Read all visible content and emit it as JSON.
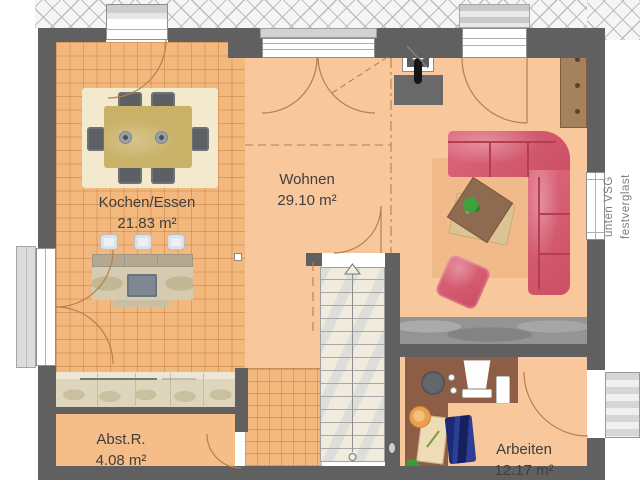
{
  "plan": {
    "rooms": [
      {
        "name": "Kochen/Essen",
        "area": "21.83 m²"
      },
      {
        "name": "Wohnen",
        "area": "29.10 m²"
      },
      {
        "name": "Abst.R.",
        "area": "4.08 m²"
      },
      {
        "name": "Arbeiten",
        "area": "12.17 m²"
      }
    ],
    "annotation": {
      "line1": "unten VSG",
      "line2": "festverglast"
    }
  },
  "colors": {
    "wall": "#606060",
    "floor_tile": "#f3b87e",
    "floor_living": "#f8c89c",
    "floor_abst": "#f5bd87",
    "sofa": "#d8536a",
    "wood": "#c9b168",
    "counter": "#ddd5bc",
    "stone": "#949494",
    "stairs": "#f0ebdc",
    "desk": "#8d5d45",
    "text": "#3e3e3e",
    "annotation_text": "#7e7e7e",
    "arc": "#b5804c"
  }
}
